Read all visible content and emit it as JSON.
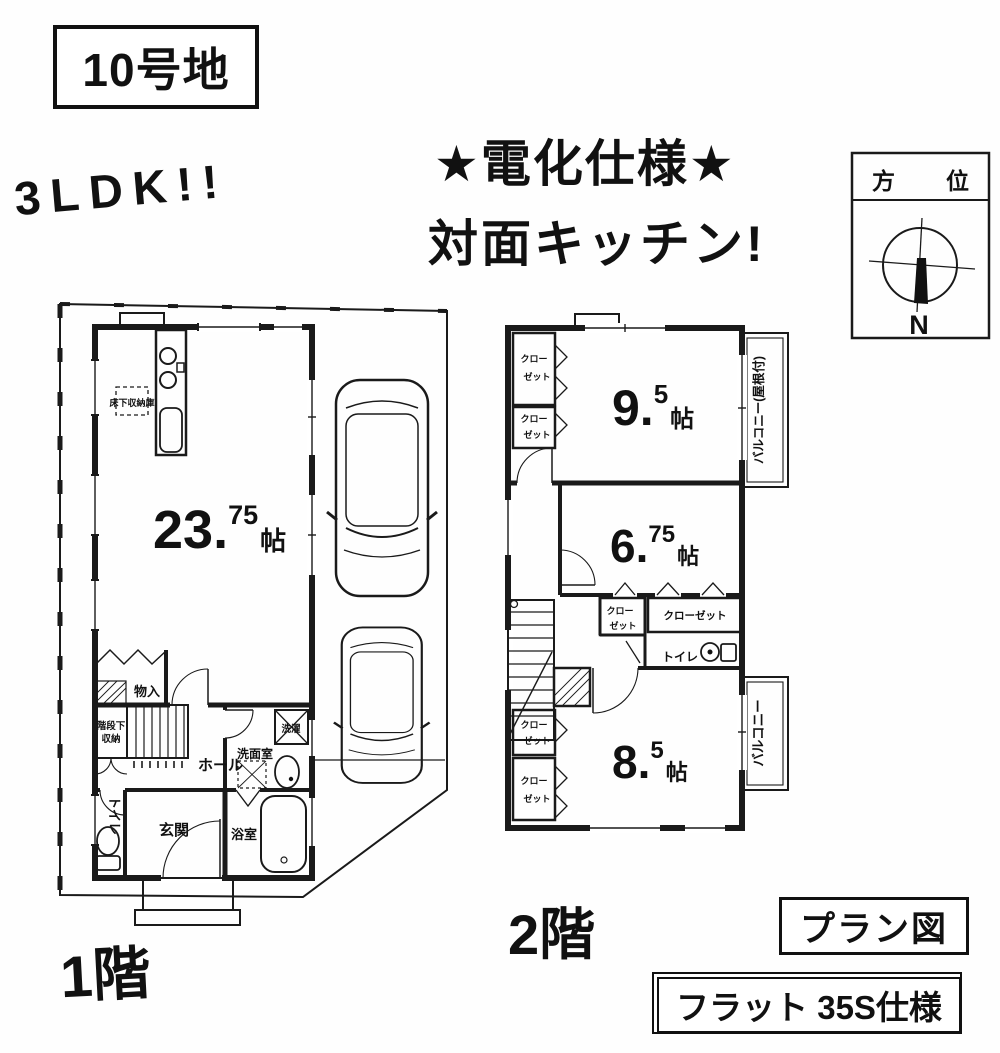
{
  "header": {
    "lot": "10号地",
    "headline": "3LDK!!",
    "feature1": "★電化仕様★",
    "feature2": "対面キッチン!"
  },
  "compass": {
    "title": "方位",
    "north": "N"
  },
  "floor1": {
    "name": "1階",
    "ldk": {
      "num": "23.",
      "sup": "75",
      "unit": "帖"
    },
    "underfloor": "床下収納庫",
    "monoire": "物入",
    "under_stair1": "階段下",
    "under_stair2": "収納",
    "hall": "ホール",
    "entrance": "玄関",
    "toilet": "トイレ",
    "washroom": "洗面室",
    "laundry": "洗濯",
    "bath": "浴室"
  },
  "floor2": {
    "name": "2階",
    "r95": {
      "num": "9.",
      "sup": "5",
      "unit": "帖"
    },
    "r675": {
      "num": "6.",
      "sup": "75",
      "unit": "帖"
    },
    "r85": {
      "num": "8.",
      "sup": "5",
      "unit": "帖"
    },
    "closet1": "クロー",
    "closet2": "ゼット",
    "closet_full": "クローゼット",
    "toilet": "トイレ",
    "balcony_roof": "バルコニー(屋根付)",
    "balcony": "バルコニー"
  },
  "footer": {
    "plan": "プラン図",
    "spec": "フラット 35S仕様"
  }
}
